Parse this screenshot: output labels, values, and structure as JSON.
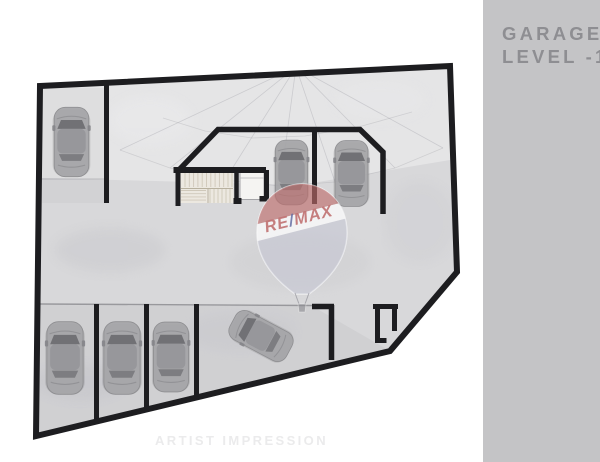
{
  "sidebar": {
    "title_line1": "GARAGE",
    "title_line2": "LEVEL -1",
    "bg_color": "#c4c4c6",
    "text_color": "#8e8e92"
  },
  "watermark": {
    "brand_re": "RE",
    "brand_slash": "/",
    "brand_max": "MAX",
    "balloon_red": "#b23c38",
    "balloon_slash_blue": "#4b5596"
  },
  "footer": {
    "caption": "ARTIST IMPRESSION"
  },
  "plan": {
    "level_label": "Garage Level -1",
    "colors": {
      "wall": "#1d1d20",
      "floor": "#d8d8da",
      "stairs_fill": "#ece8e0"
    },
    "features": {
      "stairwell": true,
      "elevator": true,
      "parked_cars": 6,
      "maneuvering_cars": 1,
      "bottom_row_dividers": 3
    },
    "cars": [
      {
        "x": 71.5,
        "y": 142,
        "rot": 0,
        "s": 1.05
      },
      {
        "x": 291.5,
        "y": 172.5,
        "rot": 0,
        "s": 0.98
      },
      {
        "x": 351.5,
        "y": 173.5,
        "rot": 0,
        "s": 1.0
      },
      {
        "x": 65,
        "y": 358,
        "rot": 0,
        "s": 1.1
      },
      {
        "x": 122,
        "y": 358,
        "rot": 0,
        "s": 1.1
      },
      {
        "x": 171,
        "y": 357,
        "rot": 0,
        "s": 1.06
      },
      {
        "x": 261,
        "y": 336,
        "rot": -62,
        "s": 0.97
      }
    ]
  }
}
